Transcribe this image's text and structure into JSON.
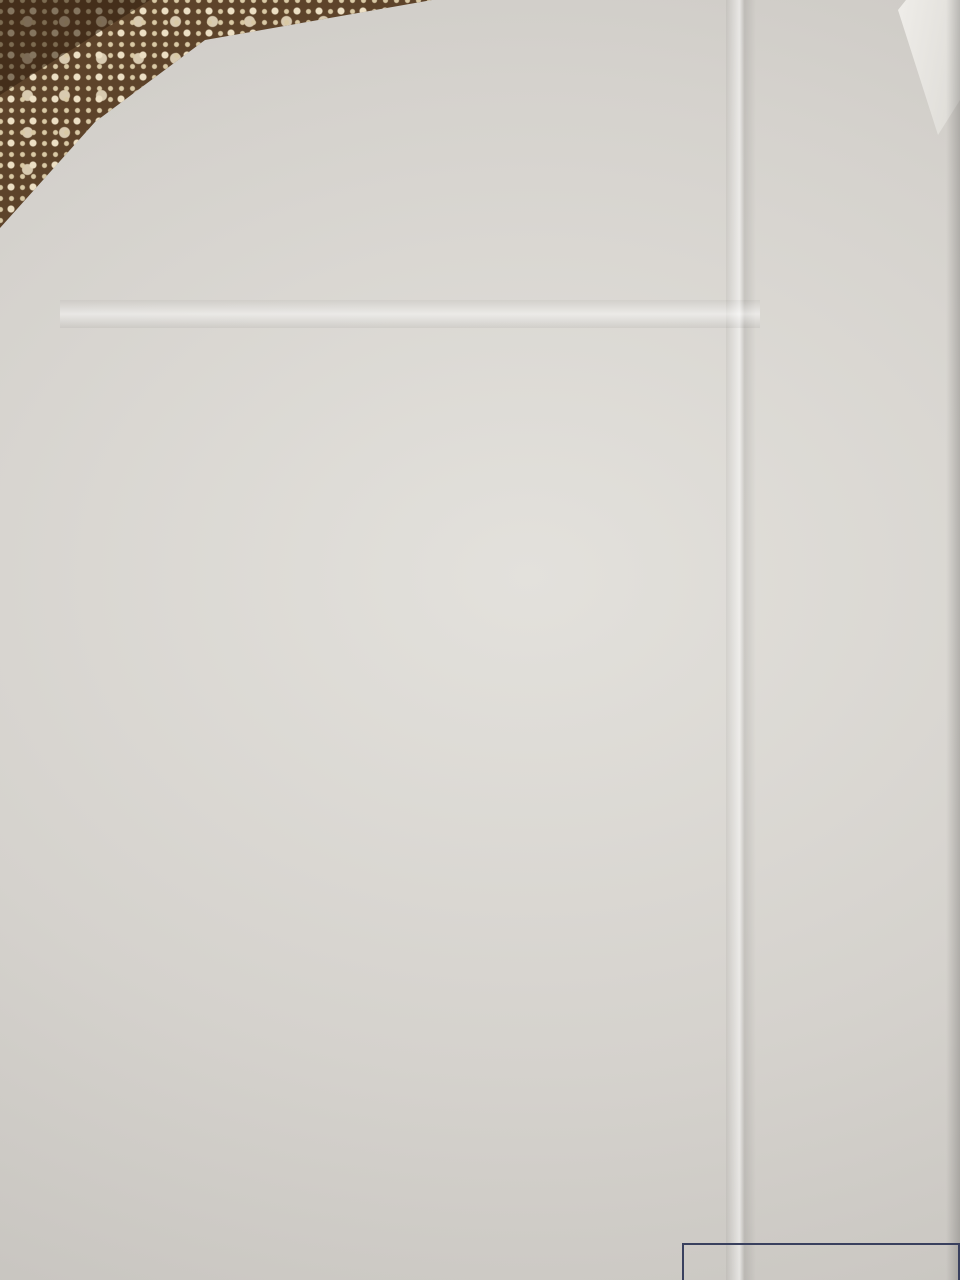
{
  "page": {
    "appendix_label": "Приложение",
    "appendix_number": "2",
    "title_line1": "Поэтажный план",
    "title_line2": "1 этаж",
    "stamp_line1": "Лидский филиал РУП Гродненское агентство",
    "stamp_line2": "регистрации и земельному ка"
  },
  "litera_labels": [
    {
      "text": "лит. Г1/к",
      "x": 458,
      "y": 159
    },
    {
      "text": "лит. В",
      "x": 404,
      "y": 243
    },
    {
      "text": "лит. А2/к",
      "x": 222,
      "y": 341
    },
    {
      "text": "лит. 1",
      "x": 107,
      "y": 871
    },
    {
      "text": "лит. Б1/к",
      "x": 253,
      "y": 1066
    },
    {
      "text": "лит. В1/к",
      "x": 789,
      "y": 1018
    }
  ],
  "rooms": [
    {
      "lines": [
        "2-4",
        "жилая",
        "комната",
        "12,2 м²"
      ],
      "x": 630,
      "y": 214
    },
    {
      "lines": [
        "2-3",
        "санузел",
        "4,0 м²"
      ],
      "x": 530,
      "y": 236
    },
    {
      "lines": [
        "2-1",
        "тамбур",
        "3,8 м²"
      ],
      "x": 459,
      "y": 288
    },
    {
      "lines": [
        "2-2",
        "холл",
        "4,5 м²"
      ],
      "x": 545,
      "y": 292
    },
    {
      "lines": [
        "2-5",
        "кухня",
        "7,2 м²"
      ],
      "x": 647,
      "y": 297
    },
    {
      "lines": [
        "3-5",
        "жилая",
        "комната",
        "8,2 м²"
      ],
      "x": 320,
      "y": 384
    },
    {
      "lines": [
        "5-10",
        "лестница",
        "5,2 м²"
      ],
      "x": 436,
      "y": 363
    },
    {
      "lines": [
        "3-7",
        "жилая",
        "комната",
        "15,7 м²"
      ],
      "x": 589,
      "y": 397
    },
    {
      "lines": [
        "3-6",
        "холл",
        "5,8 м²"
      ],
      "x": 428,
      "y": 451
    },
    {
      "lines": [
        "3-4",
        "кухня",
        "8,0 м²"
      ],
      "x": 316,
      "y": 491
    },
    {
      "lines": [
        "3-3",
        "санузел",
        "4,9 м²"
      ],
      "x": 420,
      "y": 525
    },
    {
      "lines": [
        "3-8",
        "жилая",
        "комната",
        "10,1 м²"
      ],
      "x": 638,
      "y": 500
    },
    {
      "lines": [
        "3-2",
        "холл",
        "11,7 м²"
      ],
      "x": 531,
      "y": 544
    },
    {
      "lines": [
        "3-1",
        "тамбур",
        "1,2 м²"
      ],
      "x": 757,
      "y": 547
    },
    {
      "lines": [
        "1-6",
        "санузел",
        "4,5 м²"
      ],
      "x": 427,
      "y": 601
    },
    {
      "lines": [
        "4-4",
        "санузел",
        "4,2 м²"
      ],
      "x": 519,
      "y": 654
    },
    {
      "lines": [
        "4-5",
        "жилая",
        "комната",
        "10,9 м²"
      ],
      "x": 635,
      "y": 661
    },
    {
      "lines": [
        "4-1",
        "тамбур",
        "1,2 м²"
      ],
      "x": 759,
      "y": 701
    },
    {
      "lines": [
        "1-5",
        "жилая комната",
        "с кухонным",
        "оборудованием",
        "21,9 м²"
      ],
      "x": 324,
      "y": 681
    },
    {
      "lines": [
        "1-3",
        "коридор",
        "5,3 м²"
      ],
      "x": 259,
      "y": 804
    },
    {
      "lines": [
        "1-4",
        "гардероб",
        "10,2 м²"
      ],
      "x": 380,
      "y": 806
    },
    {
      "lines": [
        "4-3",
        "жилая",
        "комната",
        "20,6 м²"
      ],
      "x": 606,
      "y": 796
    },
    {
      "lines": [
        "1-1",
        "тамбур",
        "3,3 м²"
      ],
      "x": 162,
      "y": 961
    },
    {
      "lines": [
        "1-2",
        "холл",
        "6,1 м²"
      ],
      "x": 269,
      "y": 952
    },
    {
      "lines": [
        "5-16",
        "лестничная",
        "клетка",
        "5,9 м²"
      ],
      "x": 390,
      "y": 977
    },
    {
      "lines": [
        "5-1",
        "коридор",
        "4,1 м²"
      ],
      "x": 560,
      "y": 968
    },
    {
      "lines": [
        "4-2",
        "кухня",
        "6,2 м²"
      ],
      "x": 681,
      "y": 953
    },
    {
      "lines": [
        "люк"
      ],
      "x": 600,
      "y": 590
    }
  ],
  "dims": [
    {
      "t": "6,45",
      "x": 600,
      "y": 153
    },
    {
      "t": "0,86",
      "x": 519,
      "y": 186,
      "v": 1
    },
    {
      "t": "3,35",
      "x": 486,
      "y": 198,
      "v": 1
    },
    {
      "t": "4,00",
      "x": 616,
      "y": 183
    },
    {
      "t": "h=2,72",
      "x": 671,
      "y": 180
    },
    {
      "t": "2,23",
      "x": 510,
      "y": 214,
      "v": 1
    },
    {
      "t": "1,28",
      "x": 531,
      "y": 213,
      "v": 1
    },
    {
      "t": "1,27",
      "x": 567,
      "y": 211,
      "v": 1
    },
    {
      "t": "3,05",
      "x": 707,
      "y": 213,
      "v": 1
    },
    {
      "t": "1,26",
      "x": 528,
      "y": 254
    },
    {
      "t": "0,78",
      "x": 573,
      "y": 256
    },
    {
      "t": "3,23",
      "x": 652,
      "y": 252
    },
    {
      "t": "3,12",
      "x": 647,
      "y": 268
    },
    {
      "t": "6,01",
      "x": 737,
      "y": 254,
      "v": 1
    },
    {
      "t": "1,76",
      "x": 460,
      "y": 240
    },
    {
      "t": "1,63",
      "x": 444,
      "y": 255
    },
    {
      "t": "h=2,43",
      "x": 479,
      "y": 255
    },
    {
      "t": "1,40",
      "x": 420,
      "y": 256,
      "v": 1
    },
    {
      "t": "2,53",
      "x": 483,
      "y": 267,
      "v": 1
    },
    {
      "t": "0,27",
      "x": 436,
      "y": 272
    },
    {
      "t": "1,52",
      "x": 271,
      "y": 277,
      "v": 1
    },
    {
      "t": "4,17",
      "x": 368,
      "y": 264
    },
    {
      "t": "2,20",
      "x": 549,
      "y": 268
    },
    {
      "t": "2,05",
      "x": 518,
      "y": 306,
      "v": 1
    },
    {
      "t": "0,46",
      "x": 497,
      "y": 309,
      "v": 1
    },
    {
      "t": "2,02",
      "x": 576,
      "y": 312,
      "v": 1
    },
    {
      "t": "2,30",
      "x": 602,
      "y": 295,
      "v": 1
    },
    {
      "t": "2,29",
      "x": 699,
      "y": 306,
      "v": 1
    },
    {
      "t": "3,12",
      "x": 646,
      "y": 330
    },
    {
      "t": "2,20",
      "x": 551,
      "y": 328
    },
    {
      "t": "1,24",
      "x": 418,
      "y": 309,
      "v": 1
    },
    {
      "t": "1,37",
      "x": 442,
      "y": 313,
      "v": 1
    },
    {
      "t": "1,37",
      "x": 470,
      "y": 322
    },
    {
      "t": "4,67",
      "x": 322,
      "y": 320
    },
    {
      "t": "2,90",
      "x": 322,
      "y": 344
    },
    {
      "t": "2,64",
      "x": 400,
      "y": 349
    },
    {
      "t": "2,03",
      "x": 390,
      "y": 372,
      "v": 1
    },
    {
      "t": "1,09",
      "x": 470,
      "y": 370,
      "v": 1
    },
    {
      "t": "2,96",
      "x": 368,
      "y": 392,
      "v": 1
    },
    {
      "t": "2,80",
      "x": 276,
      "y": 380,
      "v": 1
    },
    {
      "t": "5,61",
      "x": 597,
      "y": 361
    },
    {
      "t": "3,02",
      "x": 508,
      "y": 392,
      "v": 1
    },
    {
      "t": "2,70",
      "x": 699,
      "y": 397,
      "v": 1
    },
    {
      "t": "2,65",
      "x": 438,
      "y": 424
    },
    {
      "t": "2,03",
      "x": 305,
      "y": 428
    },
    {
      "t": "0,90",
      "x": 358,
      "y": 436
    },
    {
      "t": "1,77",
      "x": 297,
      "y": 444
    },
    {
      "t": "1,05",
      "x": 350,
      "y": 457
    },
    {
      "t": "2,13",
      "x": 394,
      "y": 452,
      "v": 1
    },
    {
      "t": "2,13",
      "x": 469,
      "y": 453,
      "v": 1
    },
    {
      "t": "1,67",
      "x": 529,
      "y": 441
    },
    {
      "t": "0,32",
      "x": 558,
      "y": 448,
      "v": 1
    },
    {
      "t": "3,75",
      "x": 628,
      "y": 438
    },
    {
      "t": "2,30",
      "x": 517,
      "y": 466
    },
    {
      "t": "3,63",
      "x": 626,
      "y": 463
    },
    {
      "t": "14,26",
      "x": 218,
      "y": 532,
      "v": 1
    },
    {
      "t": "2,93",
      "x": 264,
      "y": 497,
      "v": 1
    },
    {
      "t": "2,80",
      "x": 361,
      "y": 507,
      "v": 1
    },
    {
      "t": "2,85",
      "x": 308,
      "y": 536
    },
    {
      "t": "3,06",
      "x": 456,
      "y": 489
    },
    {
      "t": "2,60",
      "x": 446,
      "y": 505
    },
    {
      "t": "1,87",
      "x": 384,
      "y": 532,
      "v": 1
    },
    {
      "t": "1,87",
      "x": 469,
      "y": 534,
      "v": 1
    },
    {
      "t": "2,60",
      "x": 446,
      "y": 557
    },
    {
      "t": "2,97",
      "x": 698,
      "y": 517,
      "v": 1
    },
    {
      "t": "2,71",
      "x": 558,
      "y": 520,
      "v": 1
    },
    {
      "t": "2,90",
      "x": 578,
      "y": 516,
      "v": 1
    },
    {
      "t": "0,40",
      "x": 612,
      "y": 541,
      "v": 1
    },
    {
      "t": "1,42",
      "x": 644,
      "y": 536
    },
    {
      "t": "1,35",
      "x": 597,
      "y": 550
    },
    {
      "t": "1,14",
      "x": 648,
      "y": 557
    },
    {
      "t": "0,90",
      "x": 690,
      "y": 553
    },
    {
      "t": "0,90",
      "x": 691,
      "y": 573
    },
    {
      "t": "4,00",
      "x": 503,
      "y": 522,
      "v": 1
    },
    {
      "t": "2,95",
      "x": 783,
      "y": 507
    },
    {
      "t": "4,53",
      "x": 546,
      "y": 592
    },
    {
      "t": "1,32",
      "x": 574,
      "y": 590,
      "v": 1
    },
    {
      "t": "1,72",
      "x": 659,
      "y": 599,
      "v": 1
    },
    {
      "t": "1,30",
      "x": 684,
      "y": 603,
      "v": 1
    },
    {
      "t": "14,70",
      "x": 744,
      "y": 634,
      "v": 1
    },
    {
      "t": "4,55",
      "x": 857,
      "y": 621,
      "v": 1
    },
    {
      "t": "2,87",
      "x": 307,
      "y": 573
    },
    {
      "t": "2,57",
      "x": 410,
      "y": 577
    },
    {
      "t": "1,86",
      "x": 348,
      "y": 597,
      "v": 1
    },
    {
      "t": "1,75",
      "x": 386,
      "y": 598,
      "v": 1
    },
    {
      "t": "1,75",
      "x": 466,
      "y": 602,
      "v": 1
    },
    {
      "t": "2,60",
      "x": 402,
      "y": 624
    },
    {
      "t": "2,70",
      "x": 416,
      "y": 650
    },
    {
      "t": "1,70",
      "x": 517,
      "y": 613
    },
    {
      "t": "1,33",
      "x": 489,
      "y": 627,
      "v": 1
    },
    {
      "t": "2,70",
      "x": 539,
      "y": 627,
      "v": 1
    },
    {
      "t": "4,09",
      "x": 637,
      "y": 621
    },
    {
      "t": "2,70",
      "x": 568,
      "y": 652,
      "v": 1
    },
    {
      "t": "2,63",
      "x": 701,
      "y": 661,
      "v": 1
    },
    {
      "t": "4,08",
      "x": 622,
      "y": 704
    },
    {
      "t": "4,88",
      "x": 578,
      "y": 728
    },
    {
      "t": "1,12",
      "x": 498,
      "y": 678,
      "v": 1
    },
    {
      "t": "1,38",
      "x": 524,
      "y": 701
    },
    {
      "t": "7,55",
      "x": 246,
      "y": 699,
      "v": 1
    },
    {
      "t": "5,60",
      "x": 341,
      "y": 733
    },
    {
      "t": "2,94",
      "x": 464,
      "y": 702,
      "v": 1
    },
    {
      "t": "1,70",
      "x": 266,
      "y": 763
    },
    {
      "t": "3,78",
      "x": 381,
      "y": 768
    },
    {
      "t": "3,87",
      "x": 508,
      "y": 800,
      "v": 1
    },
    {
      "t": "1,56",
      "x": 683,
      "y": 761,
      "v": 1
    },
    {
      "t": "1,30",
      "x": 703,
      "y": 752,
      "v": 1
    },
    {
      "t": "0,93",
      "x": 710,
      "y": 773
    },
    {
      "t": "0,73",
      "x": 706,
      "y": 798
    },
    {
      "t": "0,52",
      "x": 737,
      "y": 791,
      "v": 1
    },
    {
      "t": "2,32",
      "x": 714,
      "y": 845,
      "v": 1
    },
    {
      "t": "6,60",
      "x": 818,
      "y": 834,
      "v": 1
    },
    {
      "t": "3,15",
      "x": 290,
      "y": 840,
      "v": 1
    },
    {
      "t": "2,74",
      "x": 316,
      "y": 842,
      "v": 1
    },
    {
      "t": "1,68",
      "x": 258,
      "y": 857
    },
    {
      "t": "3,82",
      "x": 385,
      "y": 862
    },
    {
      "t": "2,63",
      "x": 461,
      "y": 835,
      "v": 1
    },
    {
      "t": "h=2,75",
      "x": 533,
      "y": 866
    },
    {
      "t": "5,62",
      "x": 612,
      "y": 866
    },
    {
      "t": "1,45",
      "x": 162,
      "y": 862
    },
    {
      "t": "1,13",
      "x": 169,
      "y": 898
    },
    {
      "t": "2,70",
      "x": 148,
      "y": 927,
      "v": 1
    },
    {
      "t": "2,59",
      "x": 250,
      "y": 908
    },
    {
      "t": "0,52",
      "x": 203,
      "y": 967,
      "v": 1
    },
    {
      "t": "2,36",
      "x": 228,
      "y": 959,
      "v": 1
    },
    {
      "t": "2,36",
      "x": 322,
      "y": 945,
      "v": 1
    },
    {
      "t": "h=2,70",
      "x": 158,
      "y": 997
    },
    {
      "t": "h=2,70",
      "x": 243,
      "y": 997
    },
    {
      "t": "2,54",
      "x": 302,
      "y": 997
    },
    {
      "t": "3,32",
      "x": 96,
      "y": 985,
      "v": 1
    },
    {
      "t": "1,40",
      "x": 388,
      "y": 906
    },
    {
      "t": "2,40",
      "x": 368,
      "y": 932,
      "v": 1
    },
    {
      "t": "3,72",
      "x": 427,
      "y": 1002
    },
    {
      "t": "1,64",
      "x": 565,
      "y": 910
    },
    {
      "t": "2,40",
      "x": 538,
      "y": 932,
      "v": 1
    },
    {
      "t": "2,47",
      "x": 588,
      "y": 938,
      "v": 1
    },
    {
      "t": "1,70",
      "x": 577,
      "y": 1000
    },
    {
      "t": "0,50",
      "x": 597,
      "y": 1025
    },
    {
      "t": "2,60",
      "x": 703,
      "y": 915
    },
    {
      "t": "2,38",
      "x": 634,
      "y": 962,
      "v": 1
    },
    {
      "t": "2,40",
      "x": 721,
      "y": 957,
      "v": 1
    },
    {
      "t": "2,62",
      "x": 658,
      "y": 1003
    },
    {
      "t": "h=2,75",
      "x": 713,
      "y": 1005
    },
    {
      "t": "2,90",
      "x": 764,
      "y": 985,
      "v": 1
    },
    {
      "t": "1,45",
      "x": 791,
      "y": 972
    },
    {
      "t": "14,10",
      "x": 378,
      "y": 1047
    },
    {
      "t": "2,20",
      "x": 85,
      "y": 1082,
      "v": 1
    },
    {
      "t": "1,81",
      "x": 140,
      "y": 1158
    },
    {
      "t": "2,20",
      "x": 316,
      "y": 1093,
      "v": 1
    },
    {
      "t": "1,83",
      "x": 357,
      "y": 1158
    },
    {
      "t": "4,30",
      "x": 506,
      "y": 1128
    },
    {
      "t": "1,60",
      "x": 620,
      "y": 1085,
      "v": 1
    }
  ]
}
